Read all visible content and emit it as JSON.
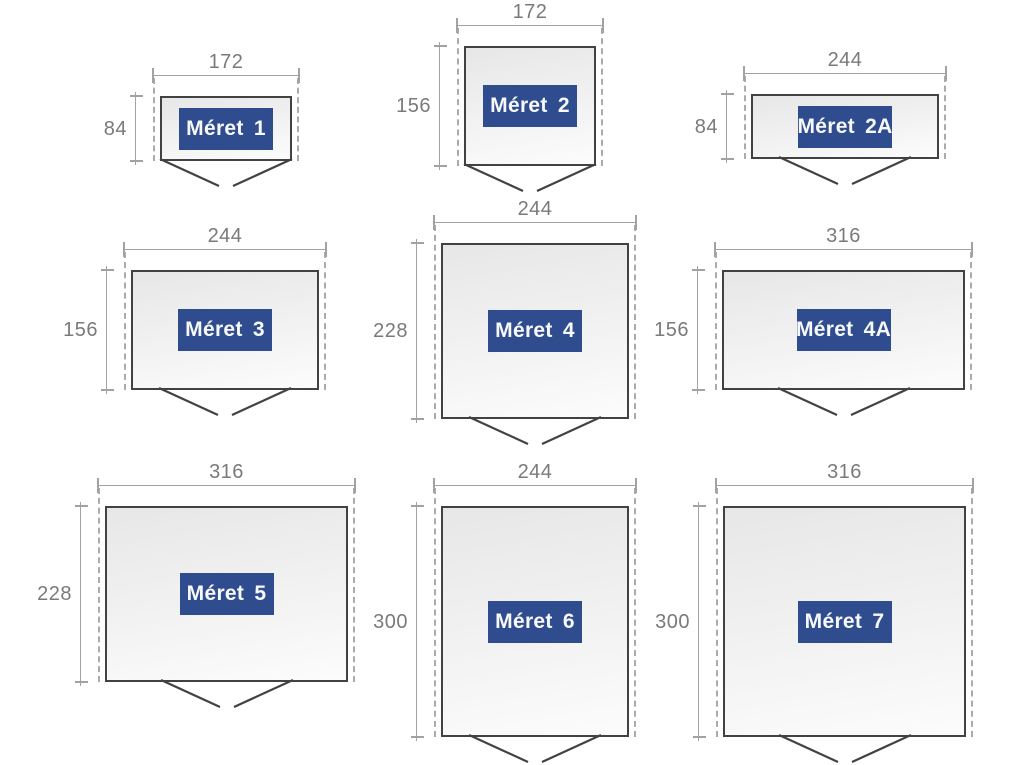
{
  "diagram": {
    "background": "#ffffff",
    "colors": {
      "outline": "#424242",
      "fill_top": "#e7e7e7",
      "fill_bottom": "#fcfcfc",
      "dashed_line": "#ababab",
      "dimension_line": "#a2a2a2",
      "dimension_text": "#7a7a7a",
      "label_bg": "#2f4d8e",
      "label_text": "#f7f8fa"
    },
    "figures": [
      {
        "id": "meret-1",
        "label": "Méret 1",
        "width": "172",
        "height": "84"
      },
      {
        "id": "meret-2",
        "label": "Méret 2",
        "width": "172",
        "height": "156"
      },
      {
        "id": "meret-2a",
        "label": "Méret 2A",
        "width": "244",
        "height": "84"
      },
      {
        "id": "meret-3",
        "label": "Méret 3",
        "width": "244",
        "height": "156"
      },
      {
        "id": "meret-4",
        "label": "Méret 4",
        "width": "244",
        "height": "228"
      },
      {
        "id": "meret-4a",
        "label": "Méret 4A",
        "width": "316",
        "height": "156"
      },
      {
        "id": "meret-5",
        "label": "Méret 5",
        "width": "316",
        "height": "228"
      },
      {
        "id": "meret-6",
        "label": "Méret 6",
        "width": "244",
        "height": "300"
      },
      {
        "id": "meret-7",
        "label": "Méret 7",
        "width": "316",
        "height": "300"
      }
    ]
  }
}
